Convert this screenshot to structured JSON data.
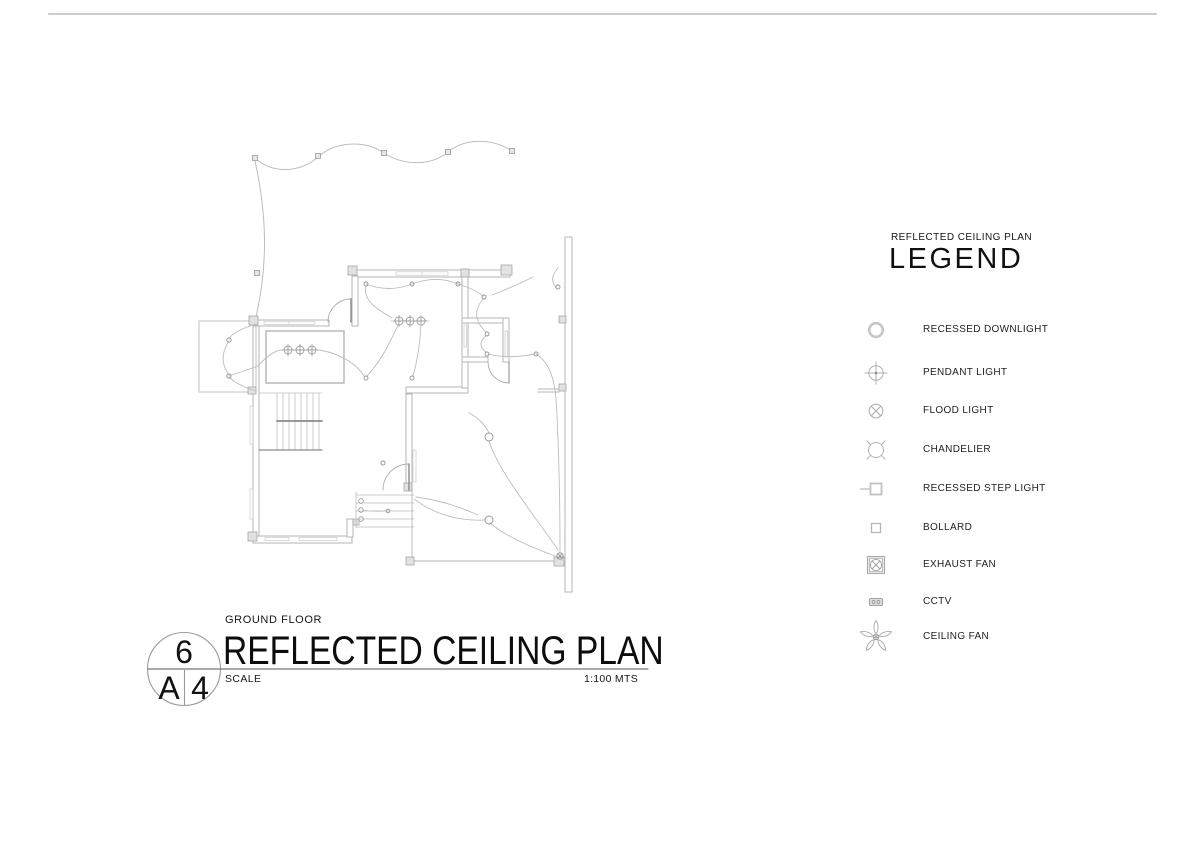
{
  "sheet": {
    "title_block": {
      "drawing_number": "6",
      "sheet_letter": "A",
      "sheet_number": "4",
      "floor_label": "GROUND FLOOR",
      "title": "REFLECTED CEILING PLAN",
      "scale_label": "SCALE",
      "scale_value": "1:100 MTS"
    },
    "legend": {
      "subtitle": "REFLECTED CEILING PLAN",
      "heading": "LEGEND",
      "items": [
        {
          "icon": "recessed-downlight-icon",
          "label": "RECESSED DOWNLIGHT"
        },
        {
          "icon": "pendant-light-icon",
          "label": "PENDANT LIGHT"
        },
        {
          "icon": "flood-light-icon",
          "label": "FLOOD LIGHT"
        },
        {
          "icon": "chandelier-icon",
          "label": "CHANDELIER"
        },
        {
          "icon": "recessed-step-light-icon",
          "label": "RECESSED STEP LIGHT"
        },
        {
          "icon": "bollard-icon",
          "label": "BOLLARD"
        },
        {
          "icon": "exhaust-fan-icon",
          "label": "EXHAUST FAN"
        },
        {
          "icon": "cctv-icon",
          "label": "CCTV"
        },
        {
          "icon": "ceiling-fan-icon",
          "label": "CEILING FAN"
        }
      ]
    },
    "colors": {
      "linework_gray": "#b9b9b9",
      "dark_line": "#787878",
      "text_black": "#1a1a1a"
    }
  }
}
